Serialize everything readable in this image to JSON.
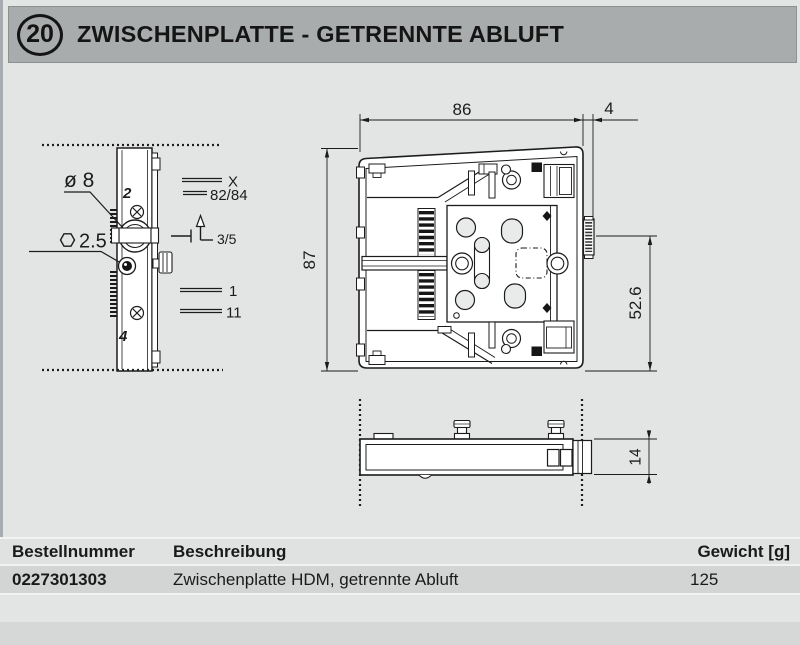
{
  "header": {
    "number": "20",
    "title": "ZWISCHENPLATTE - GETRENNTE ABLUFT"
  },
  "drawing": {
    "side_view": {
      "label_diameter": "ø 8",
      "label_hex_size": "2.5",
      "label_top": "2",
      "label_bottom": "4",
      "callout_x": "X",
      "callout_8284": "82/84",
      "callout_35": "3/5",
      "callout_1": "1",
      "callout_11": "11"
    },
    "front_view": {
      "dim_width": "86",
      "dim_offset": "4",
      "dim_height": "87",
      "dim_pin_height": "52.6"
    },
    "bottom_view": {
      "dim_thickness": "14"
    }
  },
  "table": {
    "columns": [
      "Bestellnummer",
      "Beschreibung",
      "Gewicht [g]"
    ],
    "rows": [
      {
        "order_no": "0227301303",
        "description": "Zwischenplatte HDM, getrennte Abluft",
        "weight": "125"
      }
    ]
  },
  "colors": {
    "page_bg": "#E3E5E5",
    "title_bar_bg": "#A9ACAC",
    "table_header_bg": "#E0E2E2",
    "table_row_bg": "#D3D5D5",
    "footer_bar_bg": "#D6D8D8",
    "line_color": "#1C1C1C"
  }
}
